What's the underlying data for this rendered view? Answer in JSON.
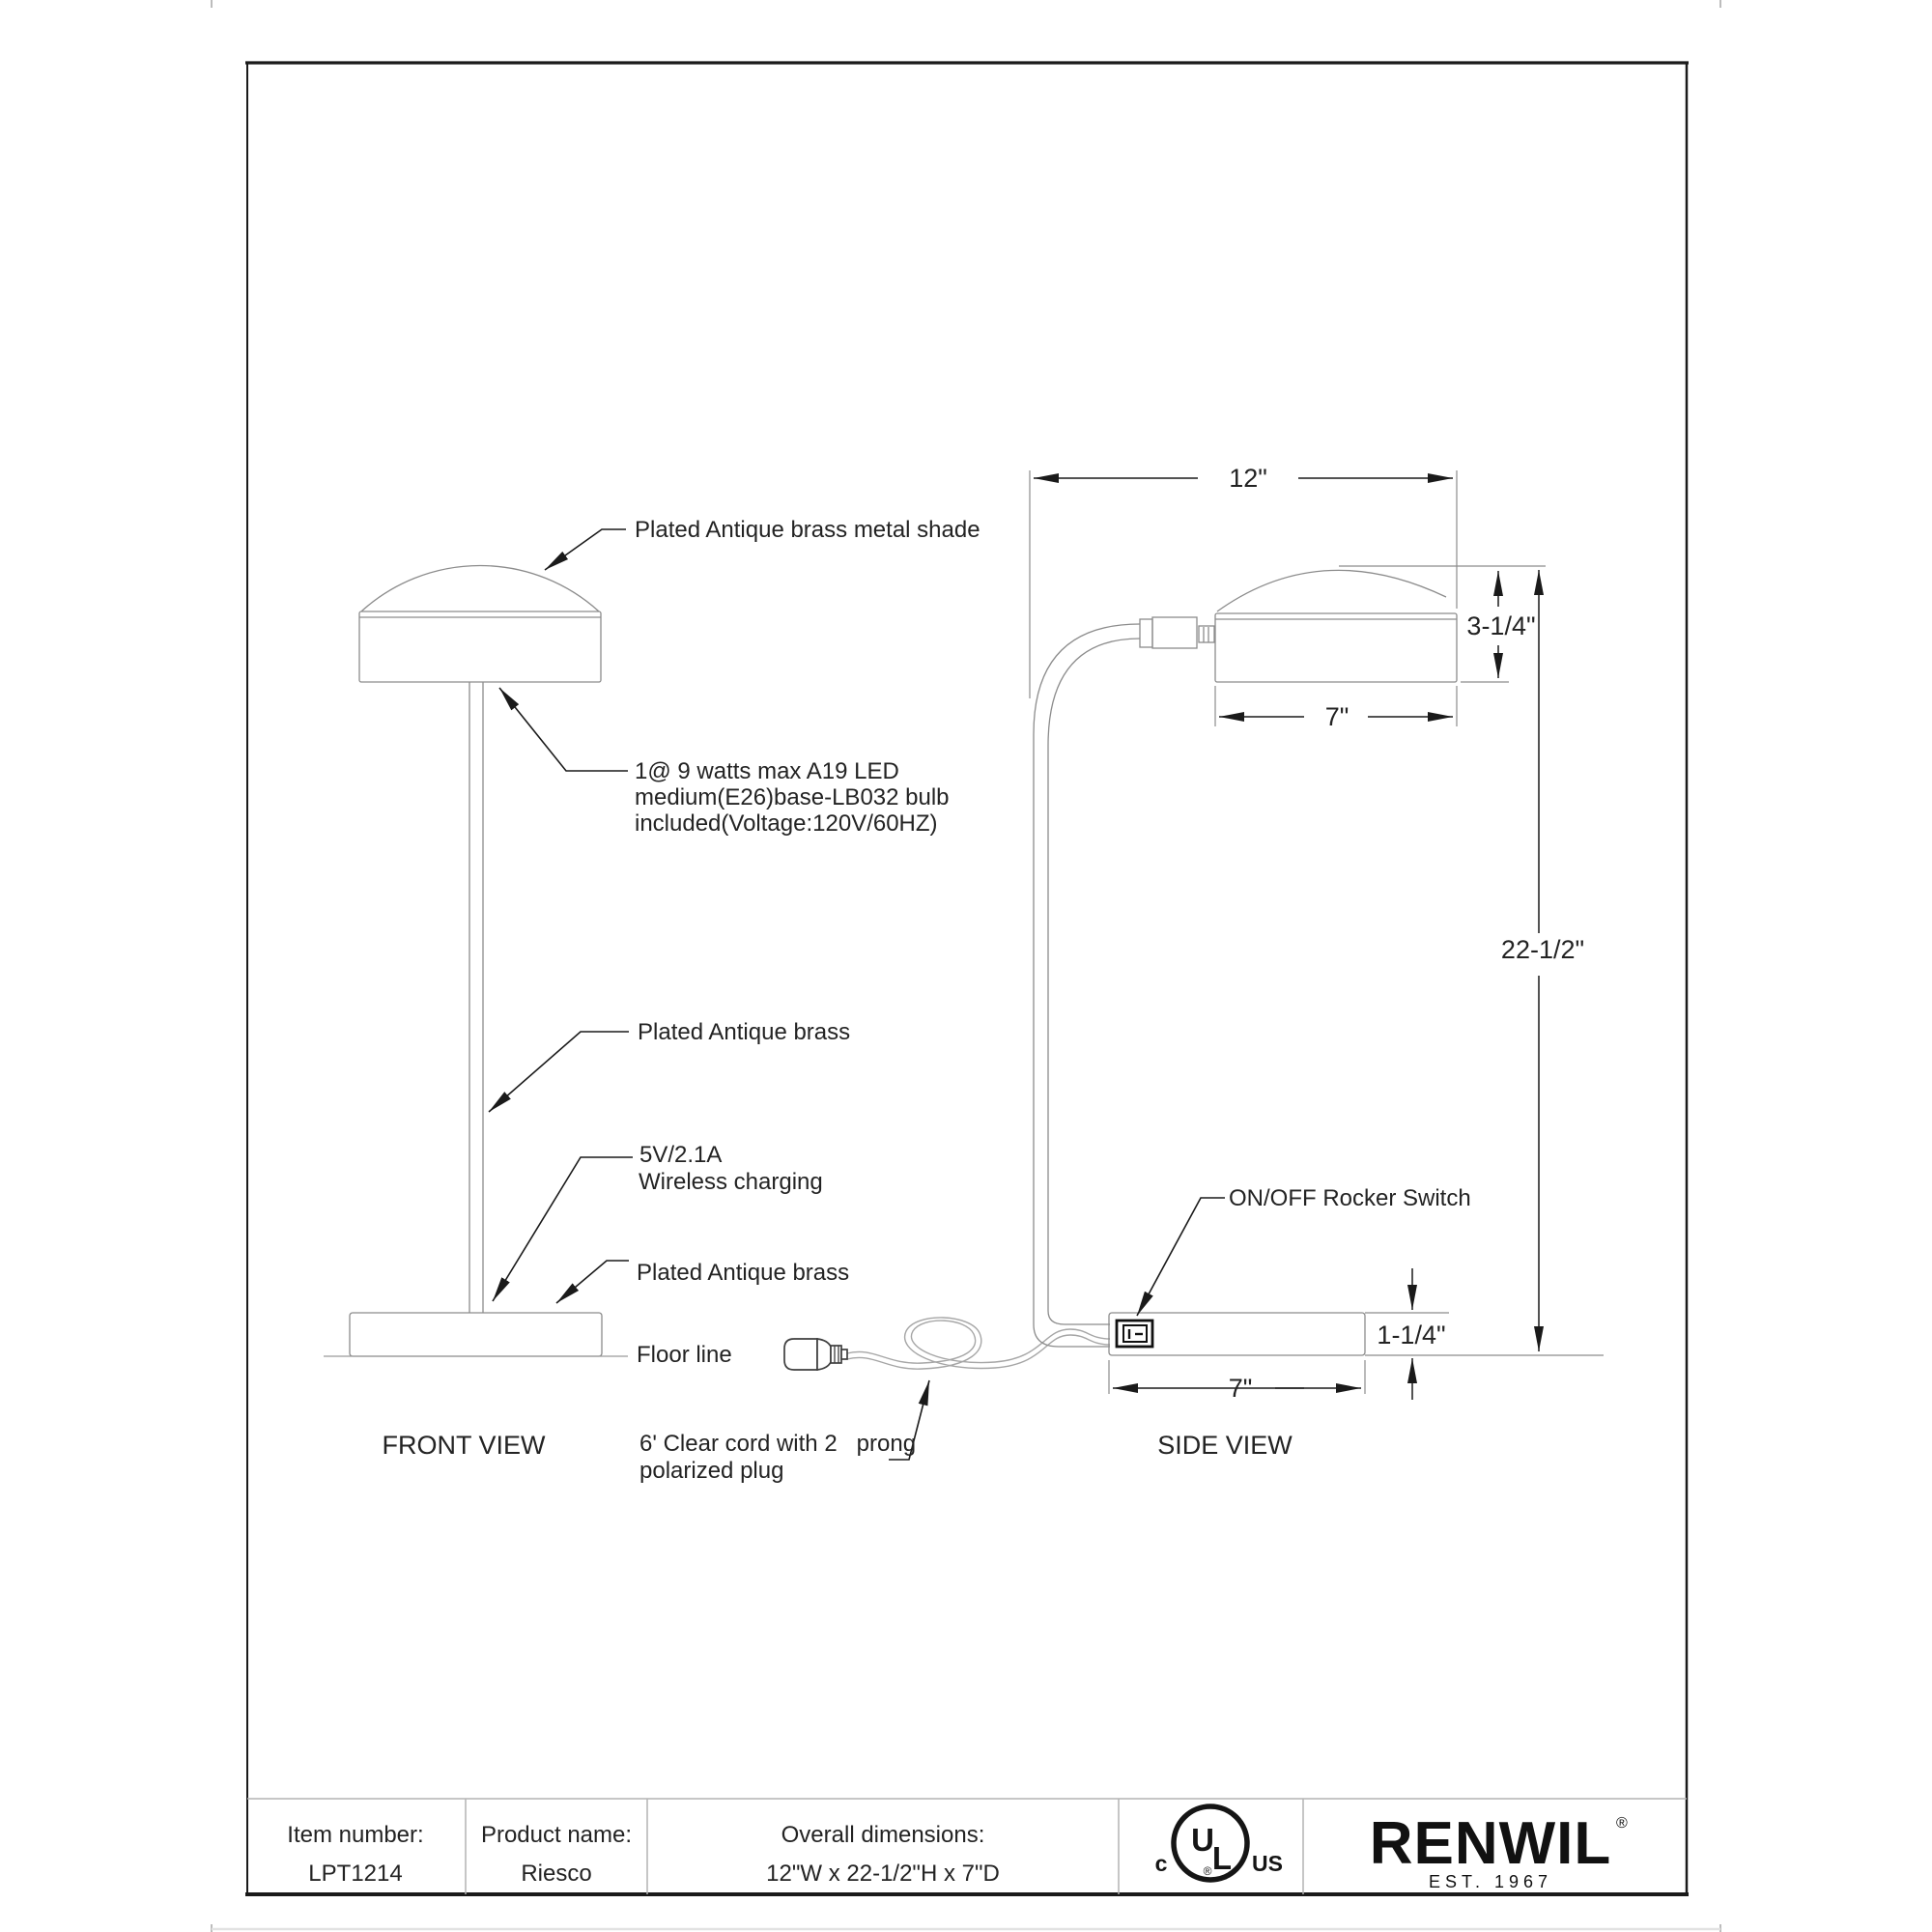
{
  "titles": {
    "front_view": "FRONT VIEW",
    "side_view": "SIDE VIEW"
  },
  "annotations": {
    "shade": "Plated Antique brass metal shade",
    "bulb_line1": "1@ 9 watts max A19 LED",
    "bulb_line2": "medium(E26)base-LB032 bulb",
    "bulb_line3": "included(Voltage:120V/60HZ)",
    "stem": "Plated Antique brass",
    "charging_line1": "5V/2.1A",
    "charging_line2": "Wireless charging",
    "base": "Plated Antique brass",
    "floor": "Floor line",
    "cord_line1": "6' Clear cord with 2   prong",
    "cord_line2": "polarized plug",
    "switch": "ON/OFF Rocker Switch"
  },
  "dimensions": {
    "overall_width": "12\"",
    "shade_height": "3-1/4\"",
    "shade_depth": "7\"",
    "overall_height": "22-1/2\"",
    "base_height": "1-1/4\"",
    "base_depth": "7\""
  },
  "footer": {
    "item_number_label": "Item number:",
    "item_number": "LPT1214",
    "product_name_label": "Product name:",
    "product_name": "Riesco",
    "dimensions_label": "Overall dimensions:",
    "dimensions_value": "12\"W x 22-1/2\"H x 7\"D",
    "ul_c": "c",
    "ul_u": "U",
    "ul_l": "L",
    "ul_us": "US",
    "ul_registered": "®",
    "brand": "RENWIL",
    "brand_registered": "®",
    "brand_est": "EST. 1967"
  },
  "colors": {
    "paper": "#ffffff",
    "geometry_line": "#8c8c8c",
    "leader_line": "#1a1a1a",
    "text": "#232323",
    "table_line": "#b3b3b3",
    "logo": "#111111"
  }
}
